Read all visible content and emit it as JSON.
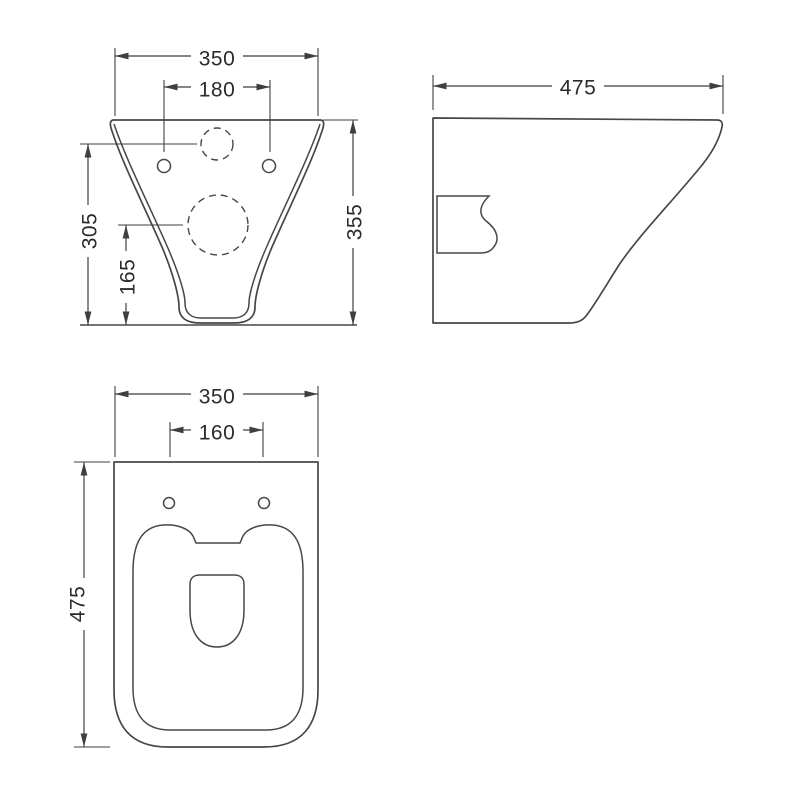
{
  "drawing": {
    "subject": "wall-hung-toilet-technical-drawing",
    "colors": {
      "background": "#ffffff",
      "line": "#474747",
      "text": "#2b2b2b"
    },
    "views": {
      "front": {
        "dims": {
          "overall_width": "350",
          "fixing_hole_spacing": "180",
          "inlet_centre_height": "305",
          "outlet_centre_height": "165",
          "overall_height": "355"
        }
      },
      "side": {
        "dims": {
          "overall_depth": "475"
        }
      },
      "plan": {
        "dims": {
          "overall_width": "350",
          "seat_hole_spacing": "160",
          "overall_depth": "475"
        }
      }
    }
  }
}
